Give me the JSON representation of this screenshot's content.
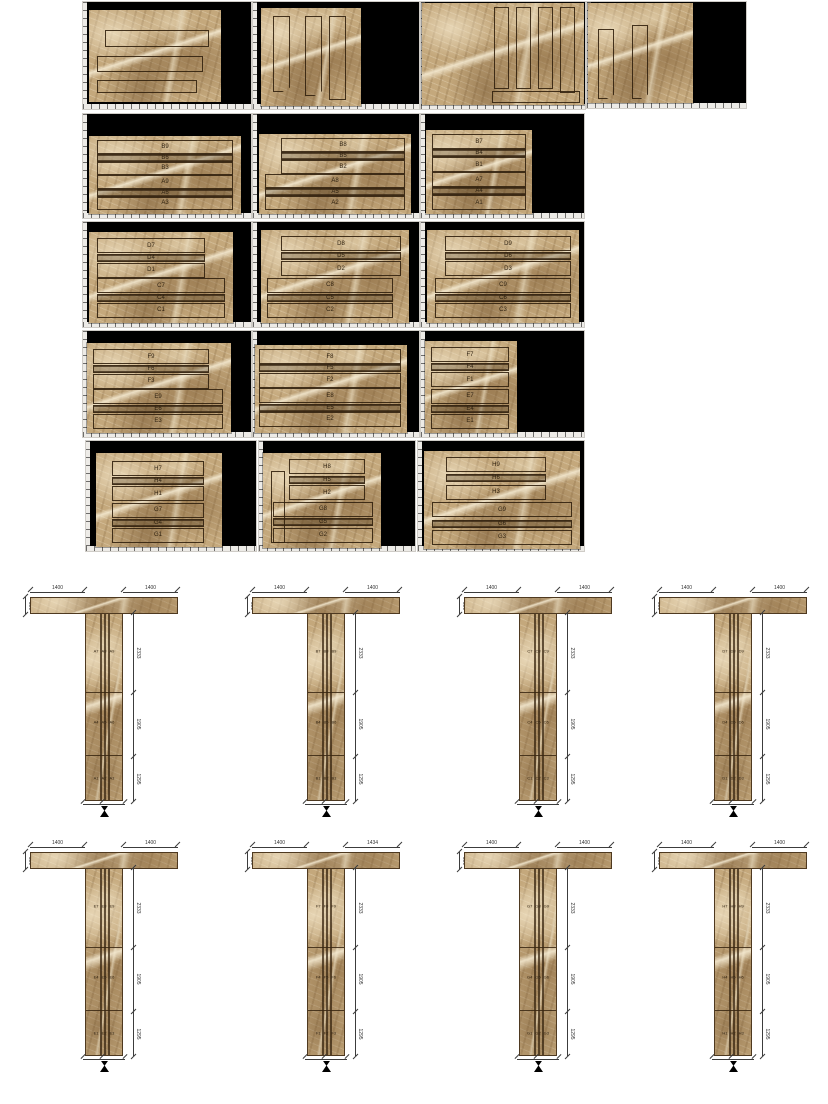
{
  "document": {
    "background": "#ffffff",
    "sheet_background": "#000000"
  },
  "colors": {
    "marble_base": "#c4a87c",
    "outline": "#32210e",
    "dimension": "#3c3c3c",
    "ruler": "#edebe7"
  },
  "cut_sheets": {
    "r2s1": {
      "labels": [
        "B9",
        "B6",
        "B3",
        "A9",
        "A6",
        "A3"
      ]
    },
    "r2s2": {
      "labels": [
        "B8",
        "B5",
        "B2",
        "A8",
        "A5",
        "A2"
      ]
    },
    "r2s3": {
      "labels": [
        "B7",
        "B4",
        "B1",
        "A7",
        "A4",
        "A1"
      ]
    },
    "r3s1": {
      "labels": [
        "D7",
        "D4",
        "D1",
        "C7",
        "C4",
        "C1"
      ]
    },
    "r3s2": {
      "labels": [
        "D8",
        "D5",
        "D2",
        "C8",
        "C5",
        "C2"
      ]
    },
    "r3s3": {
      "labels": [
        "D9",
        "D6",
        "D3",
        "C9",
        "C6",
        "C3"
      ]
    },
    "r4s1": {
      "labels": [
        "F9",
        "F6",
        "F3",
        "E9",
        "E6",
        "E3"
      ]
    },
    "r4s2": {
      "labels": [
        "F8",
        "F5",
        "F2",
        "E8",
        "E5",
        "E2"
      ]
    },
    "r4s3": {
      "labels": [
        "F7",
        "F4",
        "F1",
        "E7",
        "E4",
        "E1"
      ]
    },
    "r5s1": {
      "labels": [
        "H7",
        "H4",
        "H1",
        "G7",
        "G4",
        "G1"
      ]
    },
    "r5s2": {
      "labels": [
        "H8",
        "H5",
        "H2",
        "G8",
        "G5",
        "G2"
      ]
    },
    "r5s3": {
      "labels": [
        "H9",
        "H6",
        "H3",
        "G9",
        "G6",
        "G3"
      ]
    }
  },
  "t": {
    "A": {
      "top_left": "1400",
      "top_right": "1400",
      "end": "300",
      "side": [
        "2333",
        "1905",
        "1295"
      ],
      "panels": [
        [
          "A7",
          "A8",
          "A9"
        ],
        [
          "A4",
          "A5",
          "A6"
        ],
        [
          "A1",
          "A2",
          "A3"
        ]
      ]
    },
    "B": {
      "top_left": "1400",
      "top_right": "1400",
      "end": "300",
      "side": [
        "2333",
        "1905",
        "1295"
      ],
      "panels": [
        [
          "B7",
          "B8",
          "B9"
        ],
        [
          "B4",
          "B5",
          "B6"
        ],
        [
          "B1",
          "B2",
          "B3"
        ]
      ]
    },
    "C": {
      "top_left": "1400",
      "top_right": "1400",
      "end": "300",
      "side": [
        "2333",
        "1905",
        "1295"
      ],
      "panels": [
        [
          "C7",
          "C8",
          "C9"
        ],
        [
          "C4",
          "C5",
          "C6"
        ],
        [
          "C1",
          "C2",
          "C3"
        ]
      ]
    },
    "D": {
      "top_left": "1400",
      "top_right": "1400",
      "end": "300",
      "side": [
        "2333",
        "1905",
        "1295"
      ],
      "panels": [
        [
          "D7",
          "D8",
          "D9"
        ],
        [
          "D4",
          "D5",
          "D6"
        ],
        [
          "D1",
          "D2",
          "D3"
        ]
      ]
    },
    "E": {
      "top_left": "1400",
      "top_right": "1400",
      "end": "300",
      "side": [
        "2333",
        "1905",
        "1295"
      ],
      "panels": [
        [
          "E7",
          "E8",
          "E9"
        ],
        [
          "E4",
          "E5",
          "E6"
        ],
        [
          "E1",
          "E2",
          "E3"
        ]
      ]
    },
    "F": {
      "top_left": "1400",
      "top_right": "1434",
      "end": "300",
      "side": [
        "2333",
        "1905",
        "1295"
      ],
      "panels": [
        [
          "F7",
          "F8",
          "F9"
        ],
        [
          "F4",
          "F5",
          "F6"
        ],
        [
          "F1",
          "F2",
          "F3"
        ]
      ]
    },
    "G": {
      "top_left": "1400",
      "top_right": "1400",
      "end": "300",
      "side": [
        "2333",
        "1905",
        "1295"
      ],
      "panels": [
        [
          "G7",
          "G8",
          "G9"
        ],
        [
          "G4",
          "G5",
          "G6"
        ],
        [
          "G1",
          "G2",
          "G3"
        ]
      ]
    },
    "H": {
      "top_left": "1400",
      "top_right": "1400",
      "end": "300",
      "side": [
        "2333",
        "1905",
        "1295"
      ],
      "panels": [
        [
          "H7",
          "H8",
          "H9"
        ],
        [
          "H4",
          "H5",
          "H6"
        ],
        [
          "H1",
          "H2",
          "H3"
        ]
      ]
    }
  }
}
